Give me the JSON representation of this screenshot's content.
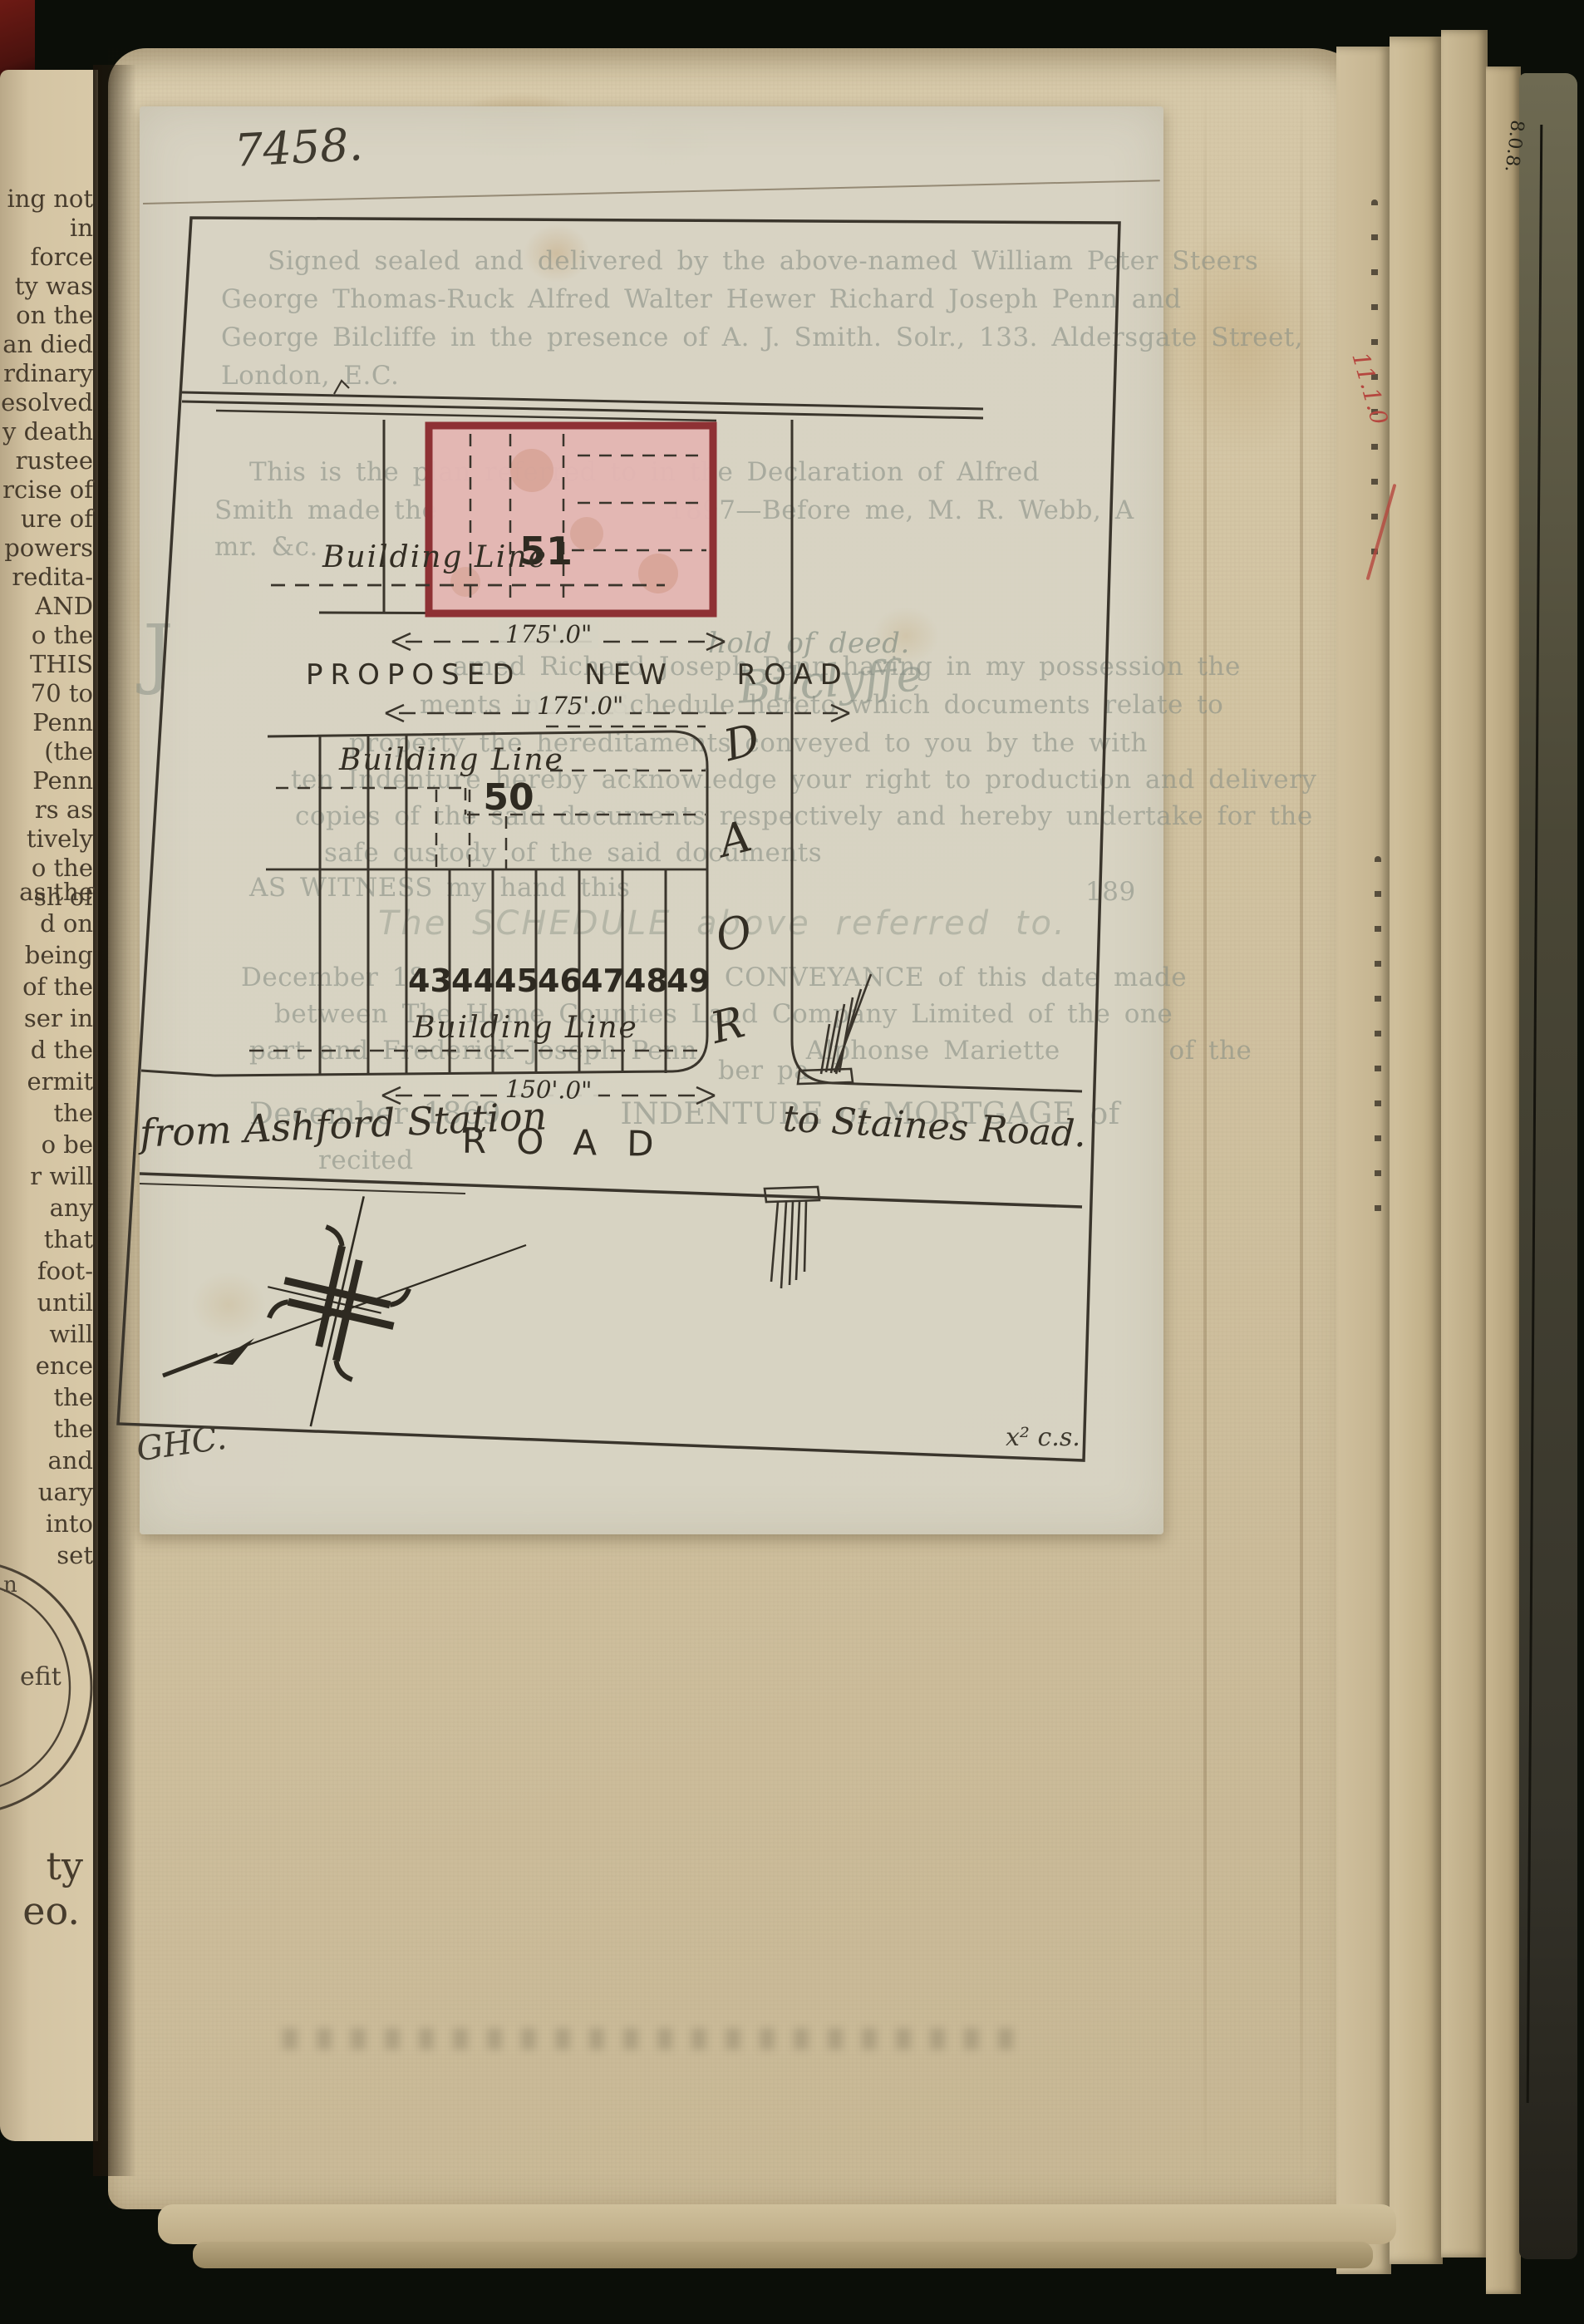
{
  "document": {
    "reference_number": "7458.",
    "surveyor_initials": "GHC.",
    "corner_note": "x² c.s."
  },
  "plan": {
    "plots": {
      "top": "51",
      "middle": "50",
      "row": [
        "43",
        "44",
        "45",
        "46",
        "47",
        "48",
        "49"
      ]
    },
    "building_line_label": "Building Line",
    "proposed_new_road": "PROPOSED NEW ROAD",
    "road_horizontal": "ROAD",
    "road_vertical_letters": [
      "R",
      "O",
      "A",
      "D"
    ],
    "from_label": "from Ashford Station",
    "to_label": "to Staines Road.",
    "dim_175": "175'.0\"",
    "dim_150": "150'.0\""
  },
  "show_through": {
    "attestation": [
      "Signed sealed and delivered by the above-named William Peter Steers",
      "George Thomas-Ruck Alfred Walter Hewer Richard Joseph Penn and",
      "George Bilcliffe in the presence of A. J. Smith. Solr., 133. Aldersgate Street,",
      "London, E.C."
    ],
    "declaration": [
      "This is the plan referred to in the Declaration of Alfred",
      "Smith made the                 1897—Before me, M. R. Webb, A",
      "mr. &c."
    ],
    "deed_note": "hold of deed.",
    "signature": "Bilclyffe",
    "drop_cap": "J",
    "acknowledgment": [
      "amed Richard Joseph Penn having in my possession the",
      "ments in the Schedule hereto which documents relate to",
      "property the hereditaments conveyed to you by the with",
      "ten Indenture hereby acknowledge your right to production and delivery",
      "copies of the said documents respectively and hereby undertake for the",
      "safe custody of the said documents"
    ],
    "witness_line": "AS WITNESS my hand this",
    "witness_year": "189",
    "schedule_heading": "The SCHEDULE above referred to.",
    "schedule": [
      "December 18                      CONVEYANCE of this date made",
      "between The Home Counties Land Company Limited of the one",
      "part and Frederick Joseph Penn        Alphonse Mariette        of the",
      "ber pa"
    ],
    "mortgage_line": "December 1869        INDENTURE of MORTGAGE of",
    "recited": "recited"
  },
  "left_page": {
    "upper_fragments": [
      "ing not",
      "in force",
      "ty was",
      "on the",
      "an died",
      "rdinary",
      "esolved",
      "y death",
      "rustee",
      "rcise of",
      "ure of",
      "powers",
      "redita-",
      "AND",
      "o the",
      "THIS",
      "70 to",
      "Penn",
      "(the",
      "Penn",
      "rs as",
      "tively",
      "o the",
      "sh of"
    ],
    "lower_fragments": [
      "as the",
      "d on",
      "being",
      "of the",
      "ser in",
      "d the",
      "ermit",
      "the",
      "o be",
      "r will",
      "any",
      "that",
      "foot-",
      "until",
      "will",
      "ence",
      "the",
      "the",
      "and",
      "uary",
      "into",
      "set"
    ],
    "seal_fragments": [
      "n",
      "efit"
    ],
    "bottom_fragments": [
      "ty",
      "eo."
    ]
  },
  "side_pages": {
    "red_annotation": "11.1.0",
    "dark_page_annotation": "8.0.8."
  },
  "colors": {
    "page": "#d3c5a4",
    "sheet": "#d7d3c4",
    "ink": "#332e24",
    "plot_fill": "#e3b6b3",
    "plot_border": "#8e3134",
    "faded_text": "#878e84",
    "red_annotation": "#b5473f",
    "background": "#0b0e08"
  }
}
